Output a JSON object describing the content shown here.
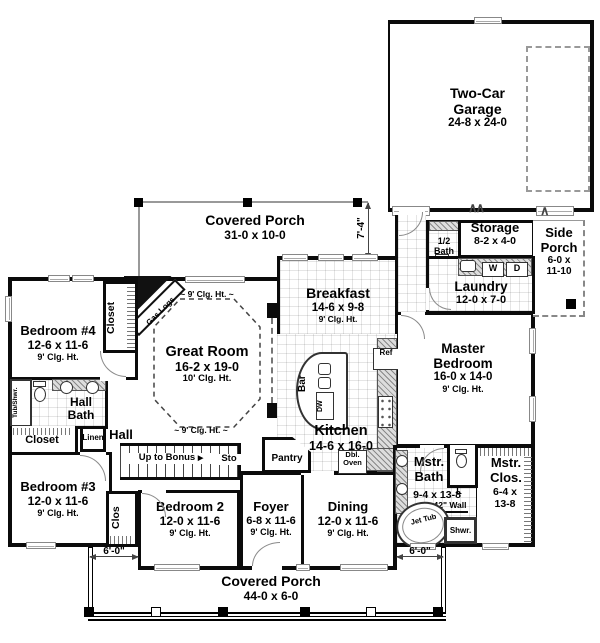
{
  "rooms": {
    "garage": {
      "name": "Two-Car Garage",
      "dims": "24-8 x 24-0"
    },
    "porch_top": {
      "name": "Covered Porch",
      "dims": "31-0 x 10-0"
    },
    "storage": {
      "name": "Storage",
      "dims": "8-2 x 4-0"
    },
    "side_porch": {
      "name": "Side Porch",
      "dims": "6-0 x 11-10"
    },
    "half_bath": {
      "name": "1/2 Bath"
    },
    "laundry": {
      "name": "Laundry",
      "dims": "12-0 x 7-0"
    },
    "breakfast": {
      "name": "Breakfast",
      "dims": "14-6 x 9-8",
      "clg": "9' Clg. Ht."
    },
    "great_room": {
      "name": "Great Room",
      "dims": "16-2 x 19-0",
      "clg": "10' Clg. Ht."
    },
    "kitchen": {
      "name": "Kitchen",
      "dims": "14-6 x 16-0"
    },
    "master_bedroom": {
      "name": "Master Bedroom",
      "dims": "16-0 x 14-0",
      "clg": "9' Clg. Ht."
    },
    "bedroom4": {
      "name": "Bedroom #4",
      "dims": "12-6 x 11-6",
      "clg": "9' Clg. Ht."
    },
    "hall_bath": {
      "name": "Hall Bath"
    },
    "bedroom3": {
      "name": "Bedroom #3",
      "dims": "12-0 x 11-6",
      "clg": "9' Clg. Ht."
    },
    "bedroom2": {
      "name": "Bedroom 2",
      "dims": "12-0 x 11-6",
      "clg": "9' Clg. Ht."
    },
    "foyer": {
      "name": "Foyer",
      "dims": "6-8 x 11-6",
      "clg": "9' Clg. Ht."
    },
    "dining": {
      "name": "Dining",
      "dims": "12-0 x 11-6",
      "clg": "9' Clg. Ht."
    },
    "master_bath": {
      "name": "Mstr. Bath",
      "dims": "9-4 x 13-8"
    },
    "master_closet": {
      "name": "Mstr. Clos.",
      "dims": "6-4 x 13-8"
    },
    "porch_bottom": {
      "name": "Covered Porch",
      "dims": "44-0 x 6-0"
    }
  },
  "labels": {
    "closet_b4": "Closet",
    "closet_b3": "Closet",
    "clos": "Clos",
    "linen": "Linen",
    "hall": "Hall",
    "up_to_bonus": "Up to Bonus",
    "sto": "Sto",
    "pantry": "Pantry",
    "bar": "Bar",
    "dw": "DW",
    "ref": "Ref",
    "dbl_oven": "Dbl. Oven",
    "gas_logs": "Gas Logs",
    "washer": "W",
    "dryer": "D",
    "jet_tub": "Jet Tub",
    "shower": "Shwr.",
    "linen_small": "L",
    "wall_42": "42\" Wall",
    "tub_shwr": "Tub/Shwr.",
    "clg_9_great": "9' Clg. Ht.",
    "clg_9_hall": "9' Clg. Ht."
  },
  "dimensions": {
    "porch_right_depth": "7'-4\"",
    "porch_left_offset": "6'-0\"",
    "porch_right_offset": "6'-0\""
  },
  "icons": {
    "door_swing": "∧∧",
    "door_swing_single": "∧",
    "up_arrow": "▶",
    "squiggle": "~"
  }
}
